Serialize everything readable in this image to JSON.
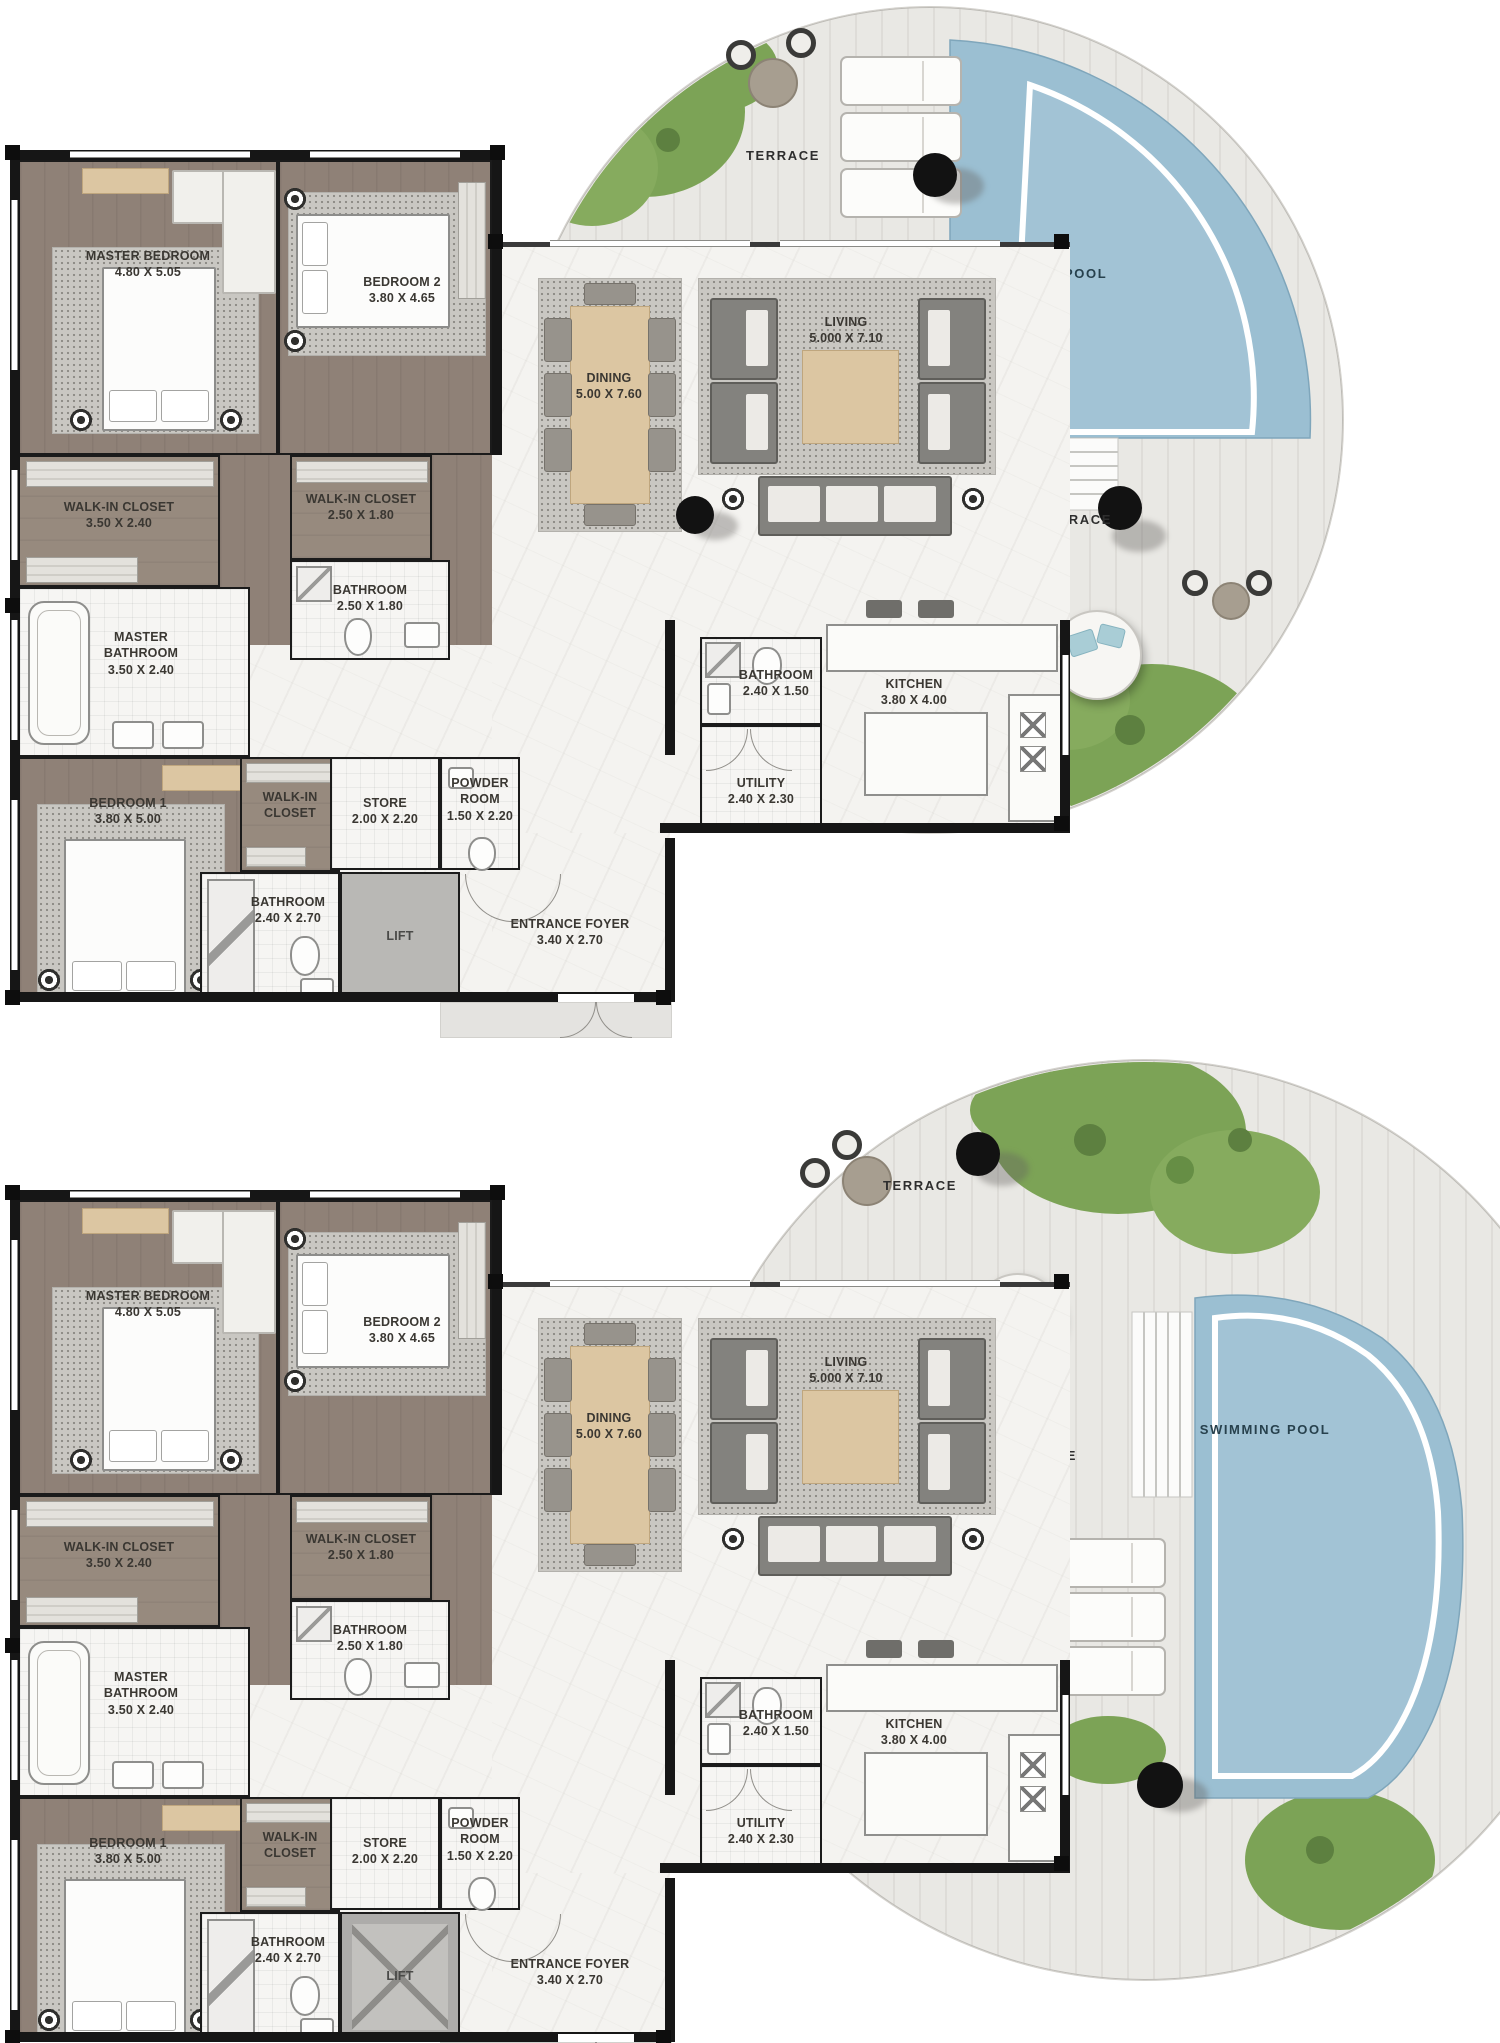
{
  "colors": {
    "wall": "#1b1b1b",
    "wood_floor": "#8f8177",
    "marble_floor": "#f4f3f0",
    "tile_floor": "#f6f5f3",
    "terrace_deck": "#e9e8e4",
    "pool_water": "#9bbfd2",
    "grass": "#7ca356",
    "lift_gray": "#b9b8b5",
    "accent_beige": "#dcc6a2",
    "label_text": "#3a3732"
  },
  "plans": [
    {
      "id": "upper-unit",
      "rooms": {
        "master_bedroom": {
          "name": "MASTER BEDROOM",
          "dims": "4.80 X 5.05"
        },
        "bedroom_2": {
          "name": "BEDROOM 2",
          "dims": "3.80 X 4.65"
        },
        "walk_in_closet_master": {
          "name": "WALK-IN CLOSET",
          "dims": "3.50 X 2.40"
        },
        "walk_in_closet_2": {
          "name": "WALK-IN CLOSET",
          "dims": "2.50 X 1.80"
        },
        "bathroom_2": {
          "name": "BATHROOM",
          "dims": "2.50 X 1.80"
        },
        "master_bathroom": {
          "name": "MASTER BATHROOM",
          "dims": "3.50 X 2.40"
        },
        "bedroom_1": {
          "name": "BEDROOM 1",
          "dims": "3.80 X 5.00"
        },
        "walk_in_closet_1": {
          "name": "WALK-IN CLOSET",
          "dims": ""
        },
        "store": {
          "name": "STORE",
          "dims": "2.00 X 2.20"
        },
        "powder_room": {
          "name": "POWDER ROOM",
          "dims": "1.50 X 2.20"
        },
        "bathroom_1": {
          "name": "BATHROOM",
          "dims": "2.40 X 2.70"
        },
        "lift": {
          "name": "LIFT",
          "dims": ""
        },
        "entrance_foyer": {
          "name": "ENTRANCE FOYER",
          "dims": "3.40 X 2.70"
        },
        "bathroom_3": {
          "name": "BATHROOM",
          "dims": "2.40 X 1.50"
        },
        "utility": {
          "name": "UTILITY",
          "dims": "2.40 X 2.30"
        },
        "kitchen": {
          "name": "KITCHEN",
          "dims": "3.80 X 4.00"
        },
        "dining": {
          "name": "DINING",
          "dims": "5.00 X 7.60"
        },
        "living": {
          "name": "LIVING",
          "dims": "5.000 X 7.10"
        }
      },
      "outdoor": {
        "terrace_top": "TERRACE",
        "terrace_side": "TERRACE",
        "swimming_pool": "SWIMMING POOL"
      }
    },
    {
      "id": "lower-unit",
      "rooms": {
        "master_bedroom": {
          "name": "MASTER BEDROOM",
          "dims": "4.80 X 5.05"
        },
        "bedroom_2": {
          "name": "BEDROOM 2",
          "dims": "3.80 X 4.65"
        },
        "walk_in_closet_master": {
          "name": "WALK-IN CLOSET",
          "dims": "3.50 X 2.40"
        },
        "walk_in_closet_2": {
          "name": "WALK-IN CLOSET",
          "dims": "2.50 X 1.80"
        },
        "bathroom_2": {
          "name": "BATHROOM",
          "dims": "2.50 X 1.80"
        },
        "master_bathroom": {
          "name": "MASTER BATHROOM",
          "dims": "3.50 X 2.40"
        },
        "bedroom_1": {
          "name": "BEDROOM 1",
          "dims": "3.80 X 5.00"
        },
        "walk_in_closet_1": {
          "name": "WALK-IN CLOSET",
          "dims": ""
        },
        "store": {
          "name": "STORE",
          "dims": "2.00 X 2.20"
        },
        "powder_room": {
          "name": "POWDER ROOM",
          "dims": "1.50 X 2.20"
        },
        "bathroom_1": {
          "name": "BATHROOM",
          "dims": "2.40 X 2.70"
        },
        "lift": {
          "name": "LIFT",
          "dims": ""
        },
        "entrance_foyer": {
          "name": "ENTRANCE FOYER",
          "dims": "3.40 X 2.70"
        },
        "bathroom_3": {
          "name": "BATHROOM",
          "dims": "2.40 X 1.50"
        },
        "utility": {
          "name": "UTILITY",
          "dims": "2.40 X 2.30"
        },
        "kitchen": {
          "name": "KITCHEN",
          "dims": "3.80 X 4.00"
        },
        "dining": {
          "name": "DINING",
          "dims": "5.00 X 7.60"
        },
        "living": {
          "name": "LIVING",
          "dims": "5.000 X 7.10"
        }
      },
      "outdoor": {
        "terrace_top": "TERRACE",
        "terrace_side": "TERRACE",
        "swimming_pool": "SWIMMING POOL"
      }
    }
  ]
}
